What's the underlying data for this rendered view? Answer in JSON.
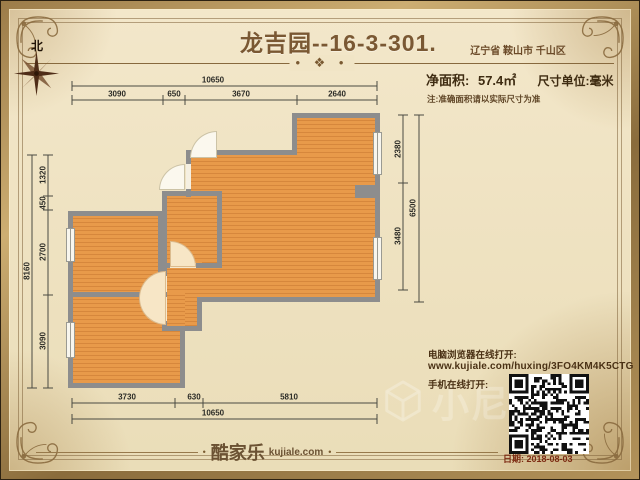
{
  "header": {
    "title": "龙吉园--16-3-301.",
    "location": "辽宁省 鞍山市 千山区",
    "area_label": "净面积:",
    "area_value": "57.4㎡",
    "unit_label": "尺寸单位:毫米",
    "note": "注:准确面积请以实际尺寸为准",
    "north_label": "北",
    "divider_ornament": "• ❖ •"
  },
  "plan": {
    "dimensions": {
      "top": {
        "overall": "10650",
        "segments": [
          "3090",
          "650",
          "3670",
          "2640"
        ]
      },
      "bottom": {
        "overall": "10650",
        "segments": [
          "3730",
          "630",
          "5810"
        ]
      },
      "left": {
        "overall": "8160",
        "segments": [
          "1320",
          "450",
          "2700",
          "3090"
        ]
      },
      "right": {
        "overall": "6500",
        "segments": [
          "2380",
          "3480"
        ]
      }
    }
  },
  "share": {
    "pc_label": "电脑浏览器在线打开:",
    "url": "www.kujiale.com/huxing/3FO4KM4K5CTG",
    "mobile_label": "手机在线打开:"
  },
  "footer": {
    "brand_cn": "酷家乐",
    "brand_domain": "kujiale.com",
    "date": "日期: 2018-08-03"
  },
  "watermark": {
    "text": "小尼"
  },
  "colors": {
    "floor_orange": "#e0923f",
    "wall_gray": "#8d8d8d",
    "accent_brown": "#7b5a33",
    "frame_gold": "#b08f55",
    "date_red": "#7c2a12"
  }
}
